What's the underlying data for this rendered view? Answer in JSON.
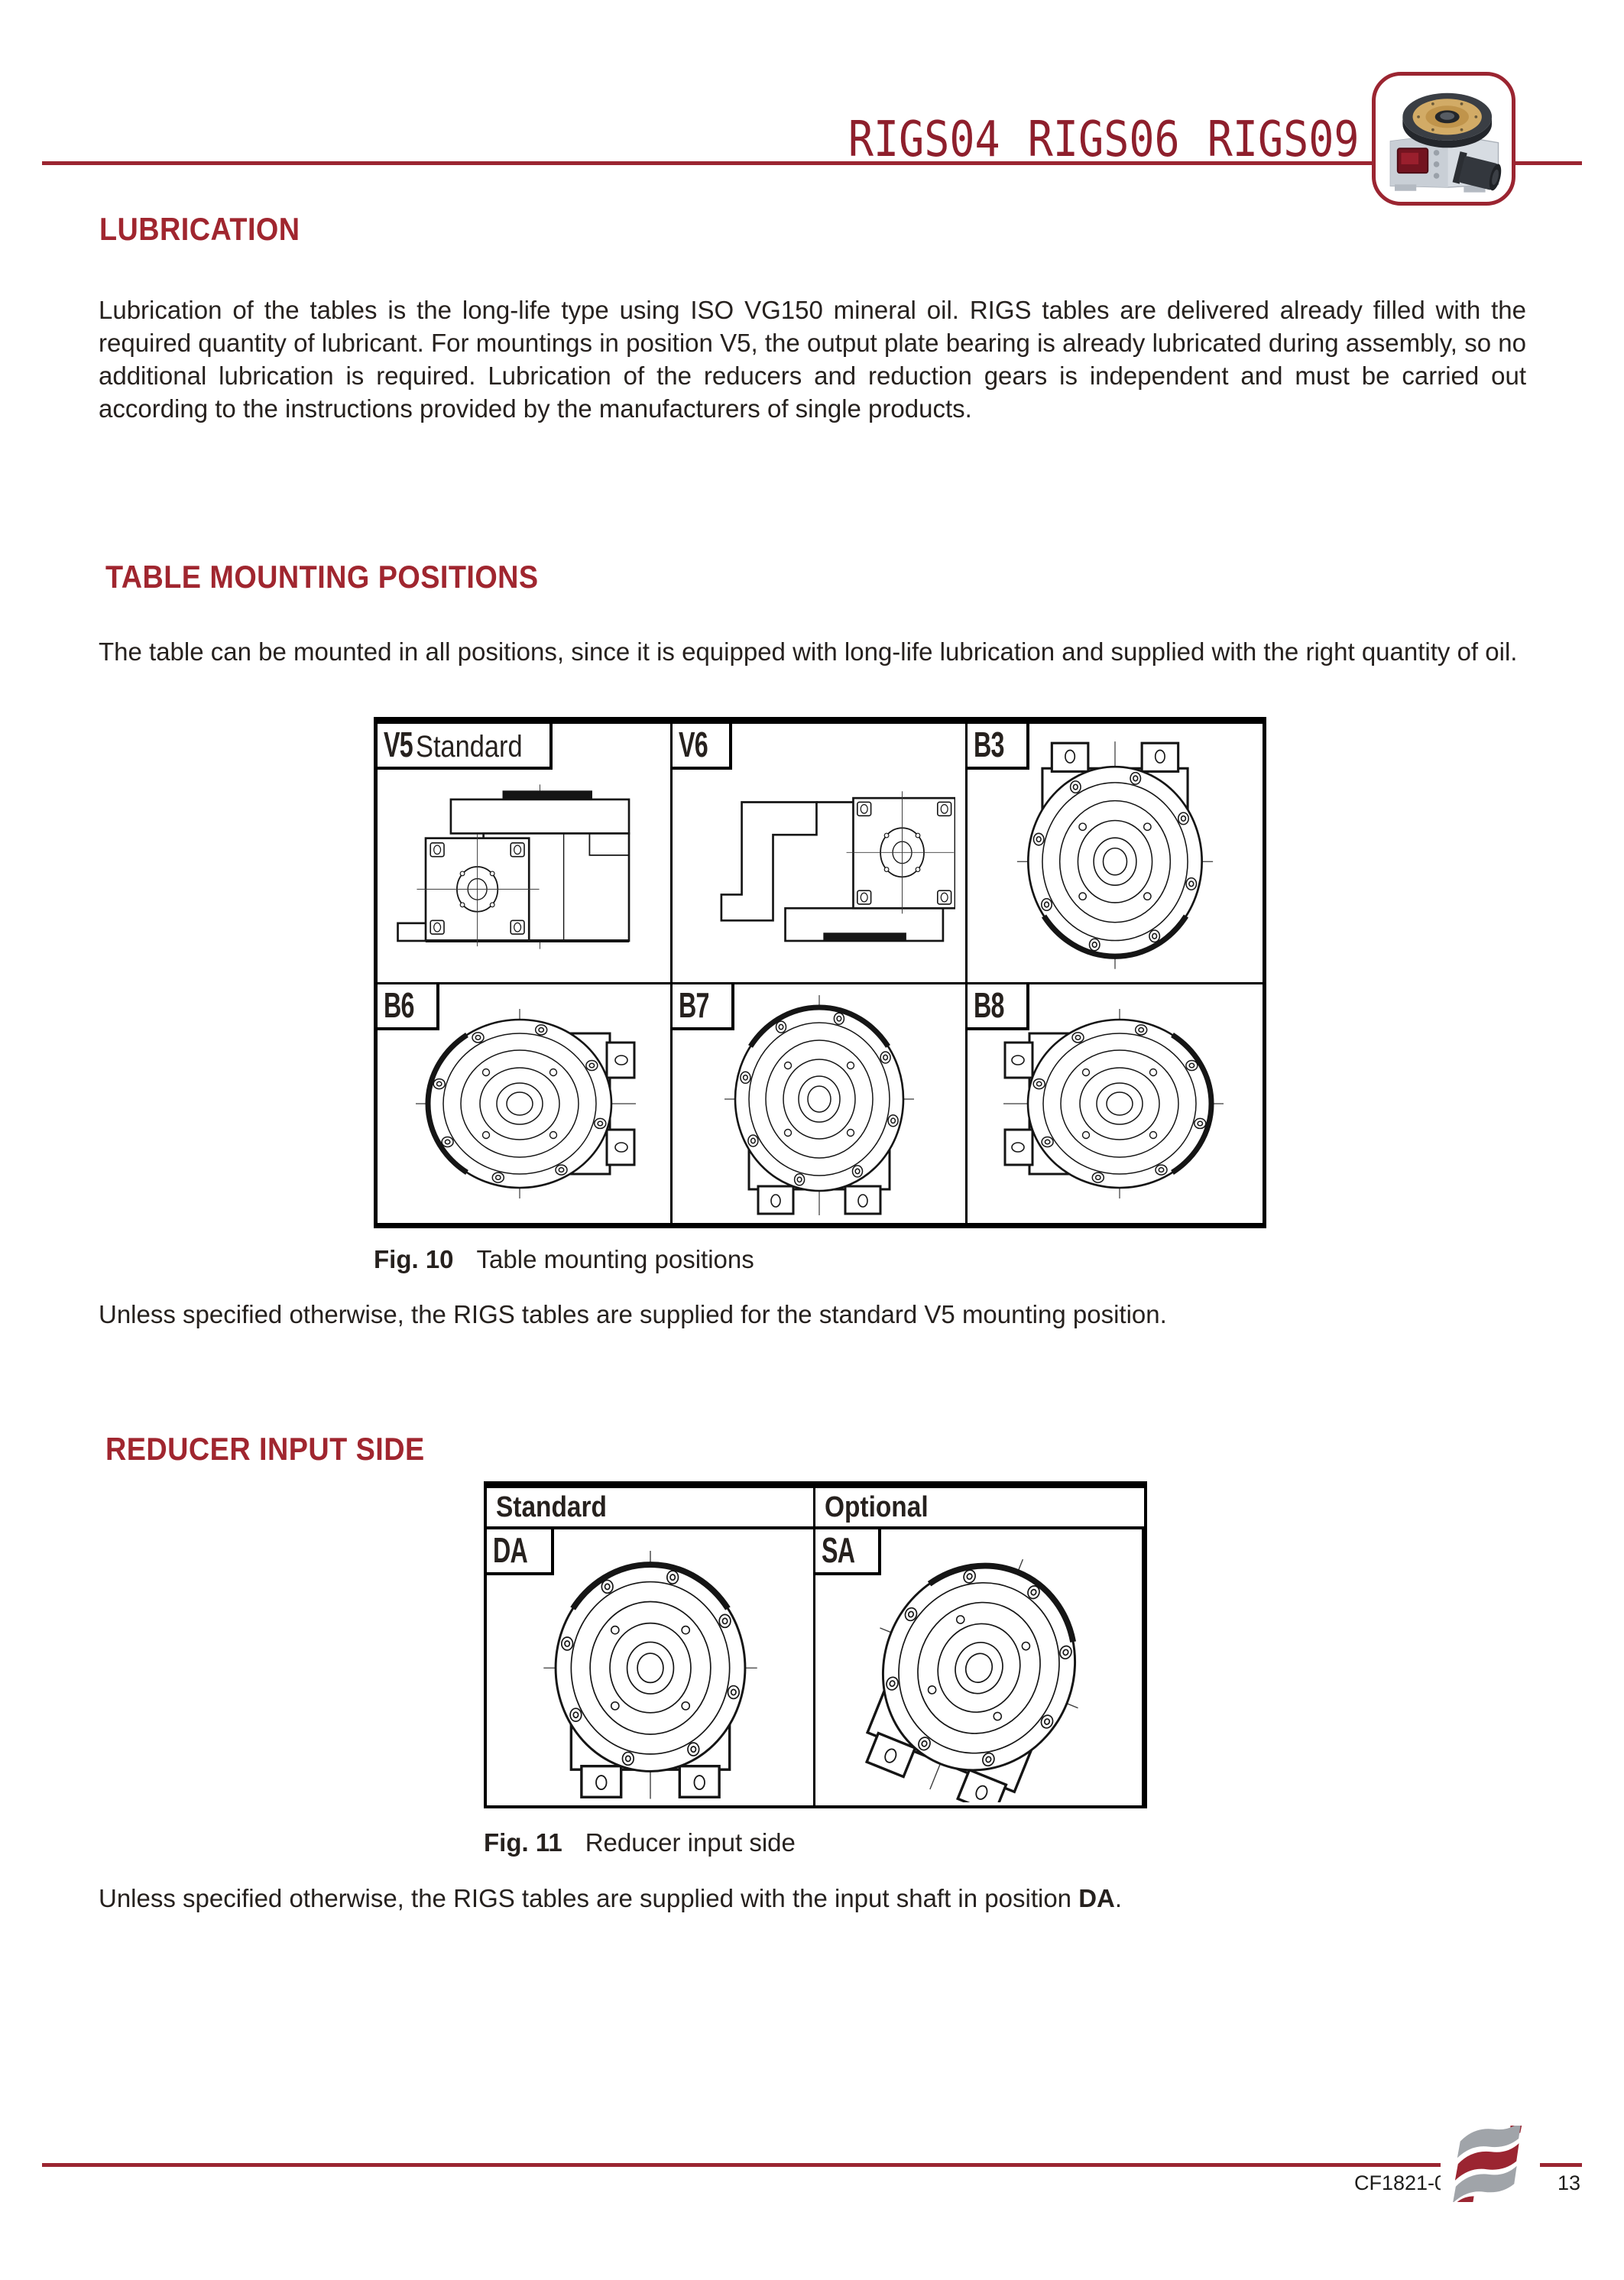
{
  "accent_color": "#9B2531",
  "header": {
    "models": [
      "RIGS04",
      "RIGS06",
      "RIGS09"
    ],
    "product_image": "rotary-index-table"
  },
  "lubrication": {
    "heading": "LUBRICATION",
    "body": "Lubrication of the tables is the long-life type using ISO VG150 mineral oil. RIGS tables are delivered already filled with the required quantity of lubricant. For mountings in position V5, the output plate bearing is already lubricated during assembly, so no additional lubrication is required. Lubrication of the reducers and reduction gears is independent and must be carried out according to the instructions provided by the manufacturers of single products."
  },
  "table_mounting": {
    "heading": "TABLE MOUNTING POSITIONS",
    "body": "The table can be mounted in all positions, since it is equipped with long-life lubrication and supplied with the right quantity of oil.",
    "figure": {
      "label": "Fig. 10",
      "caption": "Table mounting positions",
      "cells": [
        {
          "code": "V5",
          "suffix": "Standard"
        },
        {
          "code": "V6"
        },
        {
          "code": "B3"
        },
        {
          "code": "B6"
        },
        {
          "code": "B7"
        },
        {
          "code": "B8"
        }
      ]
    },
    "note": "Unless specified otherwise, the RIGS tables are supplied for the standard V5 mounting position."
  },
  "reducer_input": {
    "heading": "REDUCER INPUT SIDE",
    "figure": {
      "label": "Fig. 11",
      "caption": "Reducer input side",
      "columns": [
        {
          "header": "Standard",
          "code": "DA"
        },
        {
          "header": "Optional",
          "code": "SA"
        }
      ]
    },
    "note_prefix": "Unless specified otherwise, the RIGS tables are supplied with the input shaft in position ",
    "note_bold": "DA",
    "note_suffix": "."
  },
  "footer": {
    "doc_code": "CF1821-0",
    "page_number": "13"
  }
}
